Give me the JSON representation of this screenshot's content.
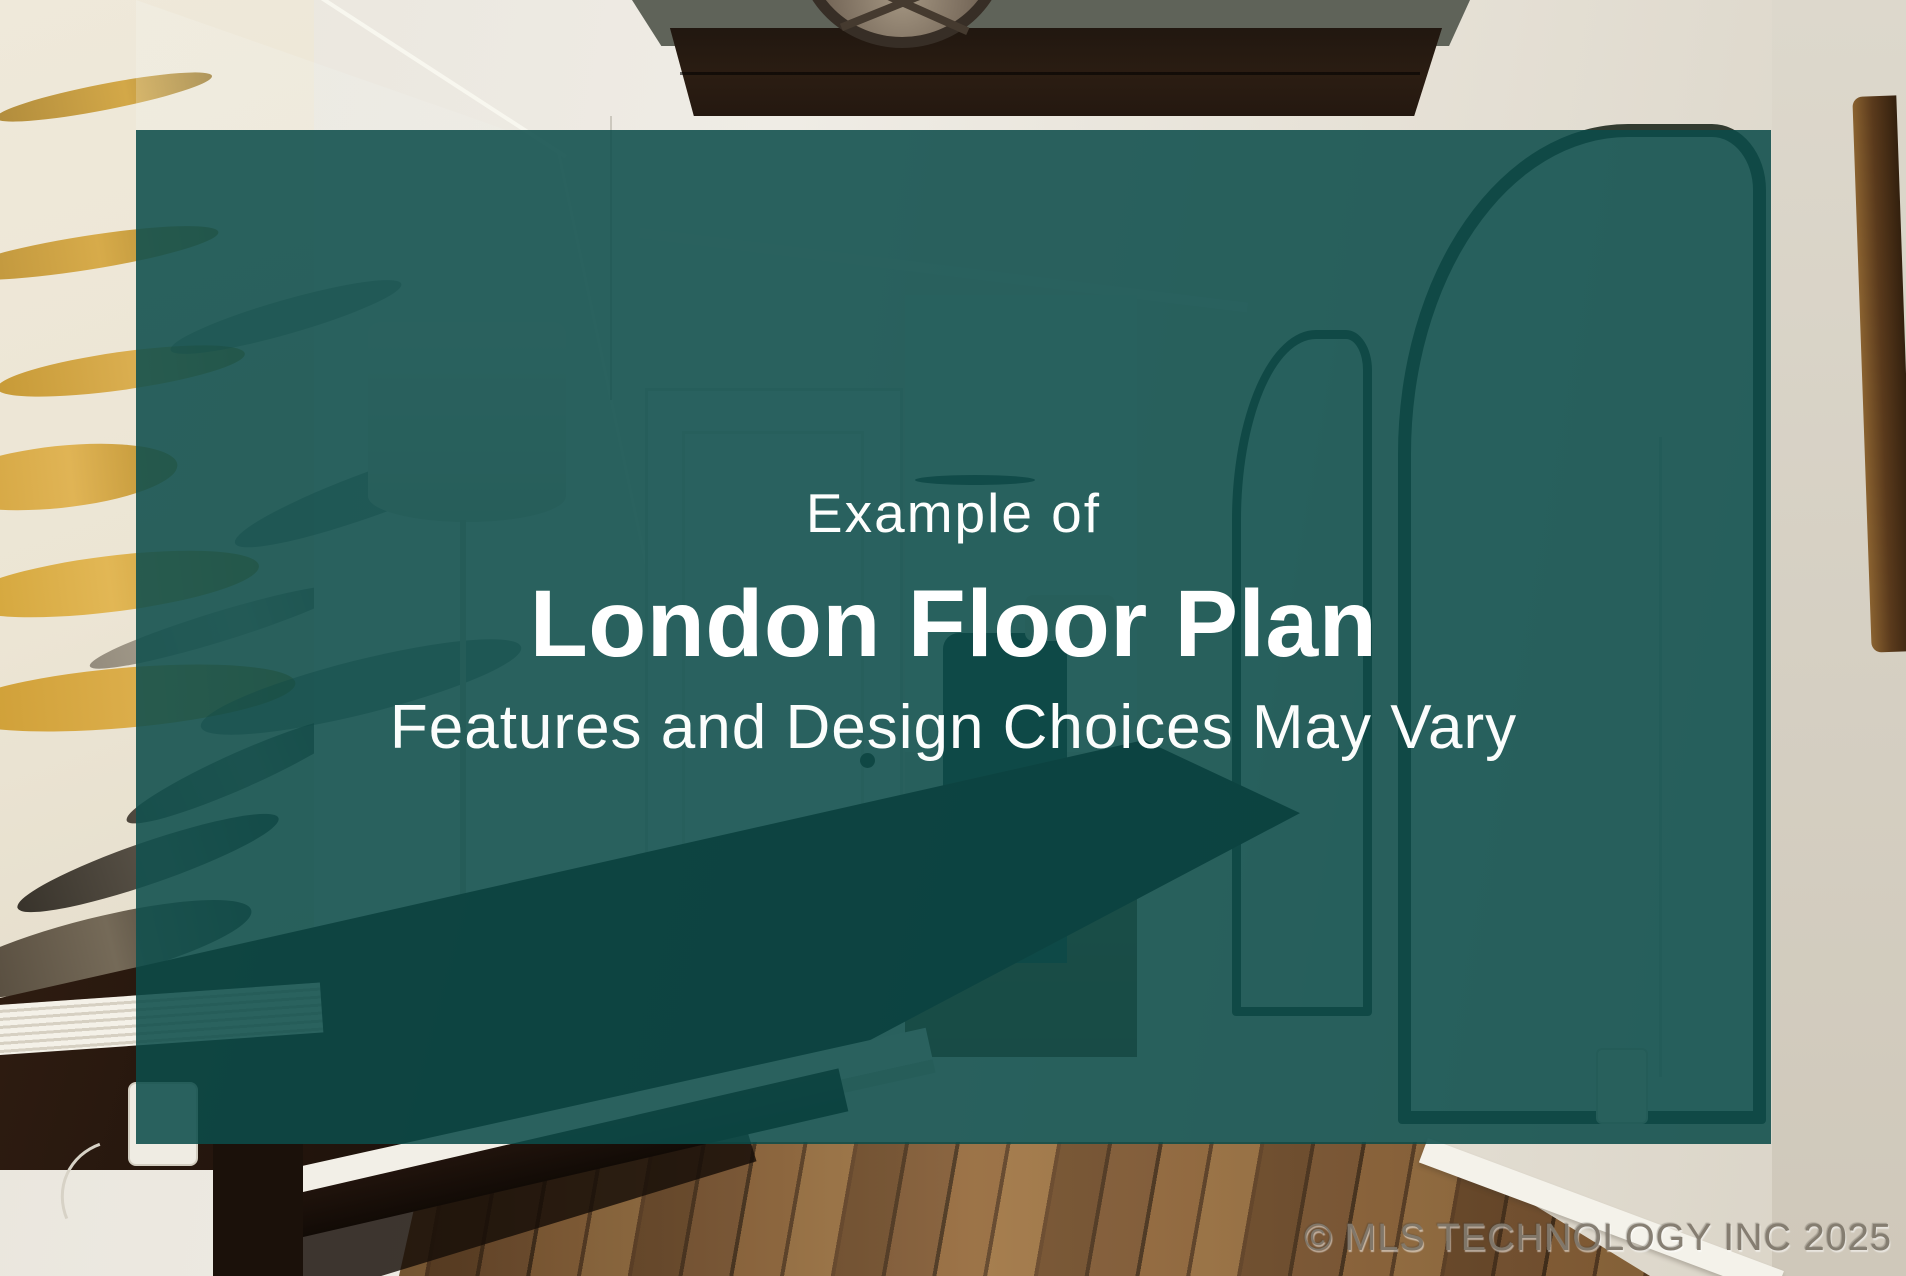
{
  "slide": {
    "overlay": {
      "eyebrow": "Example of",
      "title": "London Floor Plan",
      "subtitle": "Features and Design Choices May Vary",
      "background_color": "#0b4c49",
      "text_color": "#ffffff"
    },
    "watermark": {
      "text": "© MLS TECHNOLOGY INC 2025",
      "color": "#81796d"
    }
  }
}
